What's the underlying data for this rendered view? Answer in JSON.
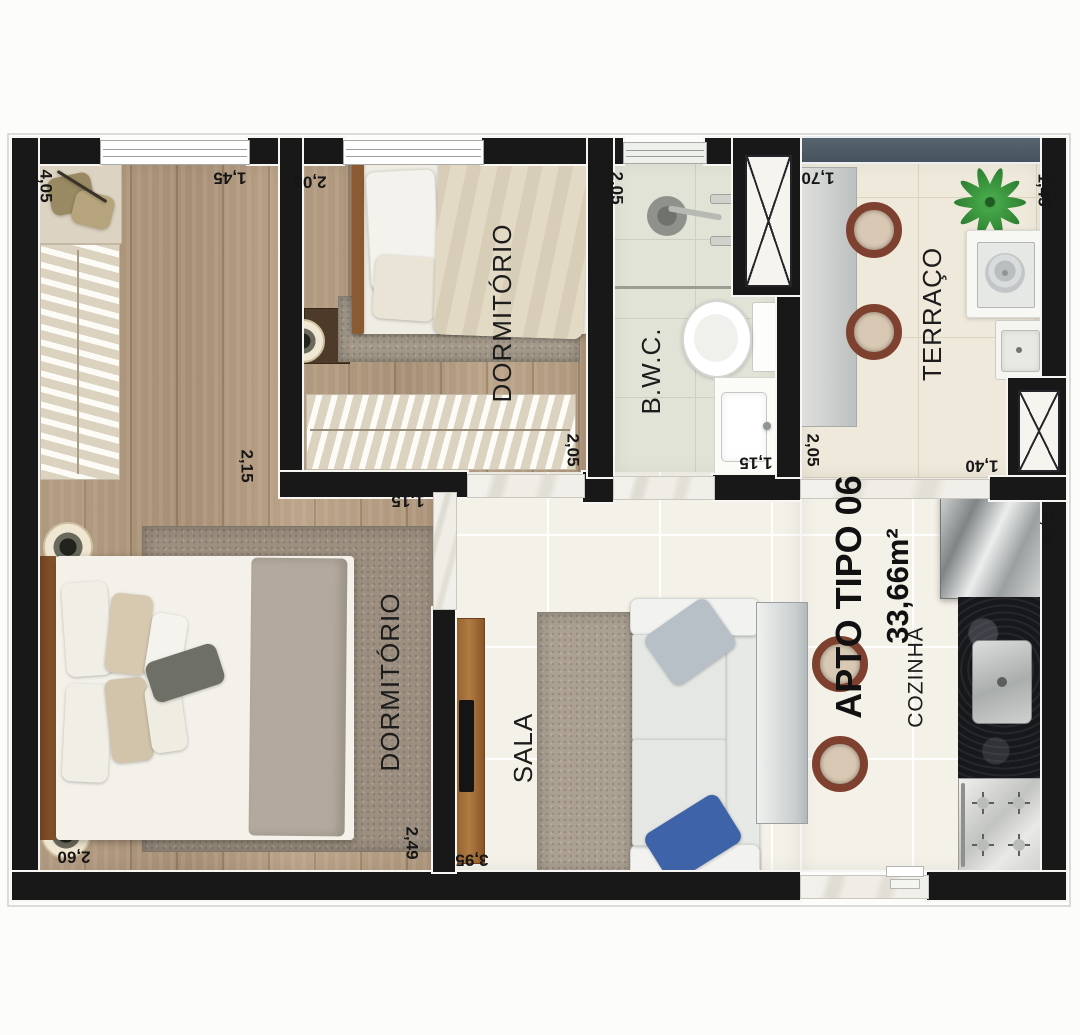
{
  "apartment": {
    "name": "APTO TIPO 06",
    "area": "33,66m²"
  },
  "rooms": {
    "dormitorio_solteiro": "DORMITÓRIO",
    "dormitorio_casal": "DORMITÓRIO",
    "bwc": "B.W.C.",
    "terraco": "TERRAÇO",
    "sala": "SALA",
    "cozinha": "COZINHA"
  },
  "dimensions": {
    "closet_len": "4,05",
    "dorm_casal_top": "1,45",
    "dorm_solteiro_top": "2,05",
    "bwc_side": "2,05",
    "terraco_top": "1,70",
    "terraco_right": "1,45",
    "dorm_casal_mid": "2,15",
    "dorm_solteiro_side": "2,05",
    "dorm_solteiro_door": "1,15",
    "bwc_door": "1,15",
    "terraco_left": "2,05",
    "terraco_door": "1,40",
    "cozinha_side": "2,49",
    "dorm_casal_bottom": "2,60",
    "dorm_casal_side": "2,49",
    "sala_bottom": "3,95"
  },
  "colors": {
    "wall": "#181818",
    "wood_floor": "#b09a7e",
    "tile_light": "#f4f1e8",
    "bath_tile": "#e2e3d7",
    "terrace_tile": "#efe9db",
    "terrace_rail": "#4c5864",
    "chair_rim": "#7e4130",
    "sofa_pillow_blue": "#3f63a8",
    "plant_green": "#2c7f31",
    "granite": "#17181b"
  }
}
